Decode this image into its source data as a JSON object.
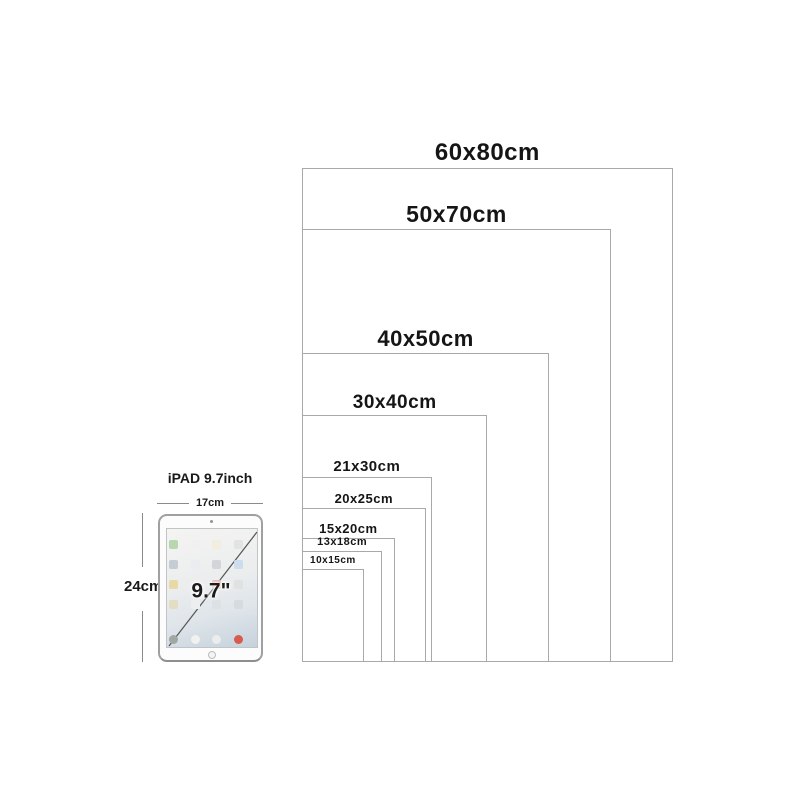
{
  "diagram": {
    "unit": "cm",
    "layout": {
      "left_px": 302,
      "bottom_px": 662,
      "px_per_cm": 6.18,
      "line_color": "#a9a9a9",
      "label_color": "#151515"
    },
    "sizes": [
      {
        "label": "60x80cm",
        "w_cm": 60,
        "h_cm": 80,
        "label_font_px": 24
      },
      {
        "label": "50x70cm",
        "w_cm": 50,
        "h_cm": 70,
        "label_font_px": 23
      },
      {
        "label": "40x50cm",
        "w_cm": 40,
        "h_cm": 50,
        "label_font_px": 22
      },
      {
        "label": "30x40cm",
        "w_cm": 30,
        "h_cm": 40,
        "label_font_px": 19
      },
      {
        "label": "21x30cm",
        "w_cm": 21,
        "h_cm": 30,
        "label_font_px": 15
      },
      {
        "label": "20x25cm",
        "w_cm": 20,
        "h_cm": 25,
        "label_font_px": 13
      },
      {
        "label": "15x20cm",
        "w_cm": 15,
        "h_cm": 20,
        "label_font_px": 13
      },
      {
        "label": "13x18cm",
        "w_cm": 13,
        "h_cm": 18,
        "label_font_px": 11
      },
      {
        "label": "10x15cm",
        "w_cm": 10,
        "h_cm": 15,
        "label_font_px": 10
      }
    ]
  },
  "ipad": {
    "title": "iPAD 9.7inch",
    "width_label": "17cm",
    "height_label": "24cm",
    "diagonal_label": "9.7\"",
    "screen_icon_colors": [
      "#b9d7ae",
      "#f0f1ef",
      "#f1eedd",
      "#e2e4e3",
      "#c6ccd4",
      "#e9edf0",
      "#d3d6d9",
      "#ccdded",
      "#e8d9a6",
      "#eef0ef",
      "#e6a89c",
      "#e0e2e1",
      "#e3ddc4",
      "#eceeef",
      "#dde1e4",
      "#d6dbe0"
    ],
    "dock_icon_colors": [
      "#9fa8a3",
      "#f1f2f0",
      "#ebeded",
      "#d85c4e"
    ]
  }
}
